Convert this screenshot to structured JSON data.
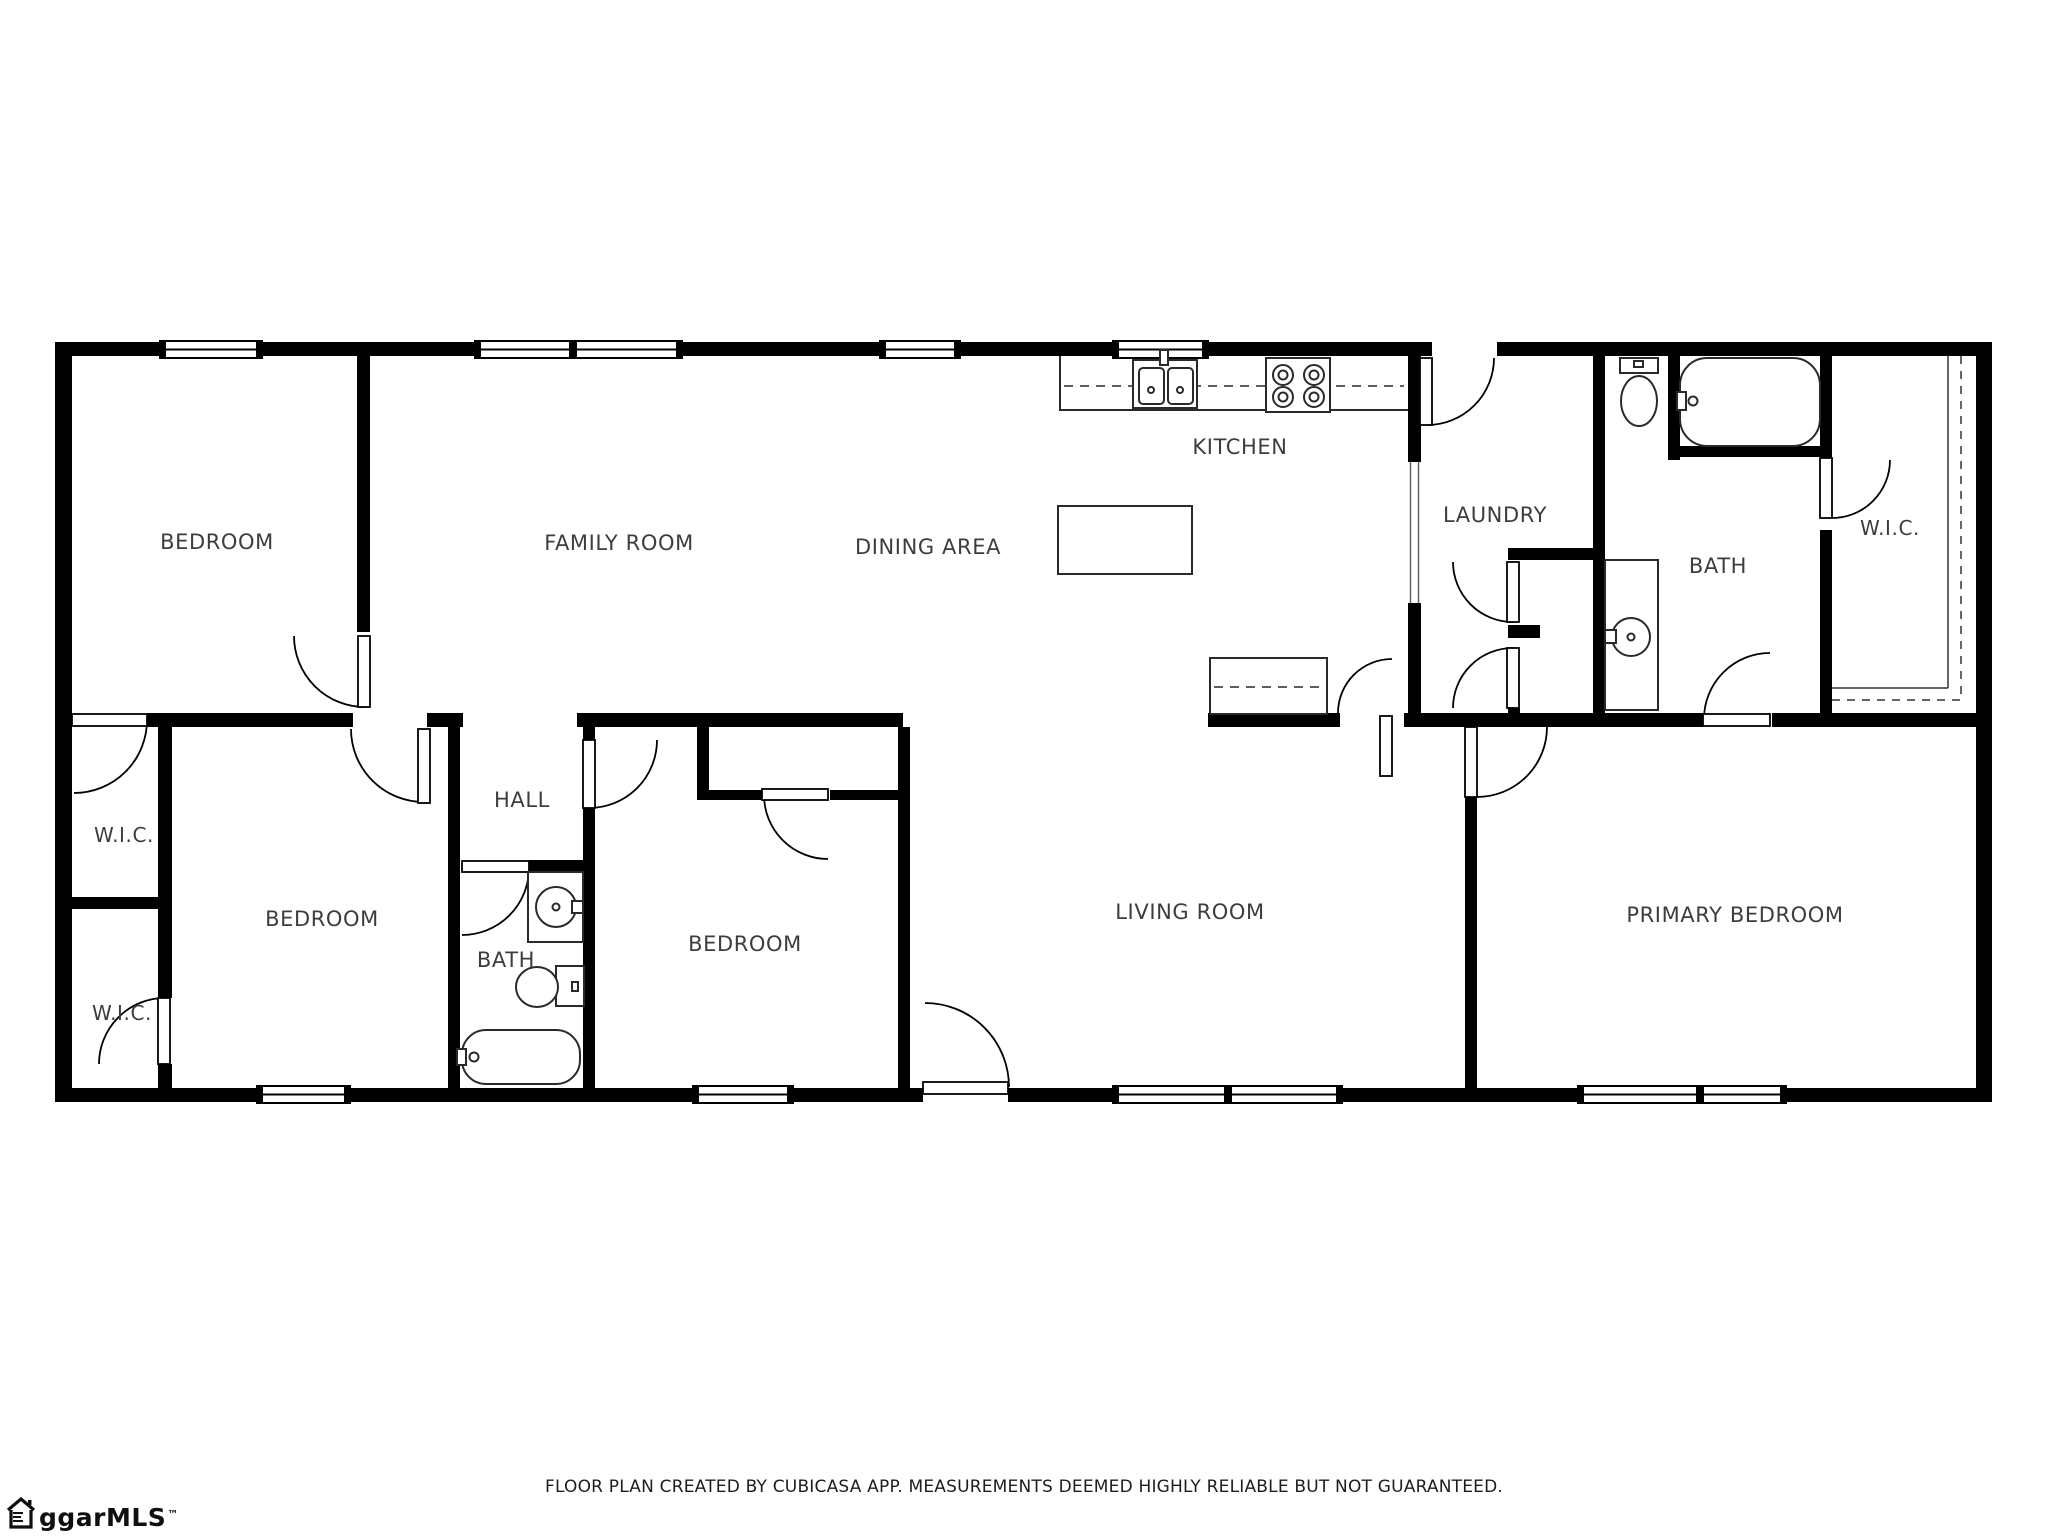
{
  "plan": {
    "background": "#ffffff",
    "wall_color": "#000000",
    "label_color": "#3d3d3d"
  },
  "rooms": [
    {
      "id": "bedroom-top-left",
      "label": "BEDROOM"
    },
    {
      "id": "family-room",
      "label": "FAMILY ROOM"
    },
    {
      "id": "dining-area",
      "label": "DINING AREA"
    },
    {
      "id": "kitchen",
      "label": "KITCHEN"
    },
    {
      "id": "laundry",
      "label": "LAUNDRY"
    },
    {
      "id": "bath-top",
      "label": "BATH"
    },
    {
      "id": "wic-top-right",
      "label": "W.I.C."
    },
    {
      "id": "wic-upper-left",
      "label": "W.I.C."
    },
    {
      "id": "bedroom-left",
      "label": "BEDROOM"
    },
    {
      "id": "hall",
      "label": "HALL"
    },
    {
      "id": "bath-hall",
      "label": "BATH"
    },
    {
      "id": "bedroom-middle",
      "label": "BEDROOM"
    },
    {
      "id": "living-room",
      "label": "LIVING ROOM"
    },
    {
      "id": "primary-bedroom",
      "label": "PRIMARY BEDROOM"
    },
    {
      "id": "wic-lower-left",
      "label": "W.I.C."
    }
  ],
  "footer": {
    "disclaimer": "FLOOR PLAN CREATED BY CUBICASA APP. MEASUREMENTS DEEMED HIGHLY RELIABLE BUT NOT GUARANTEED."
  },
  "branding": {
    "logo_text": "ggarMLS",
    "trademark": "™"
  }
}
